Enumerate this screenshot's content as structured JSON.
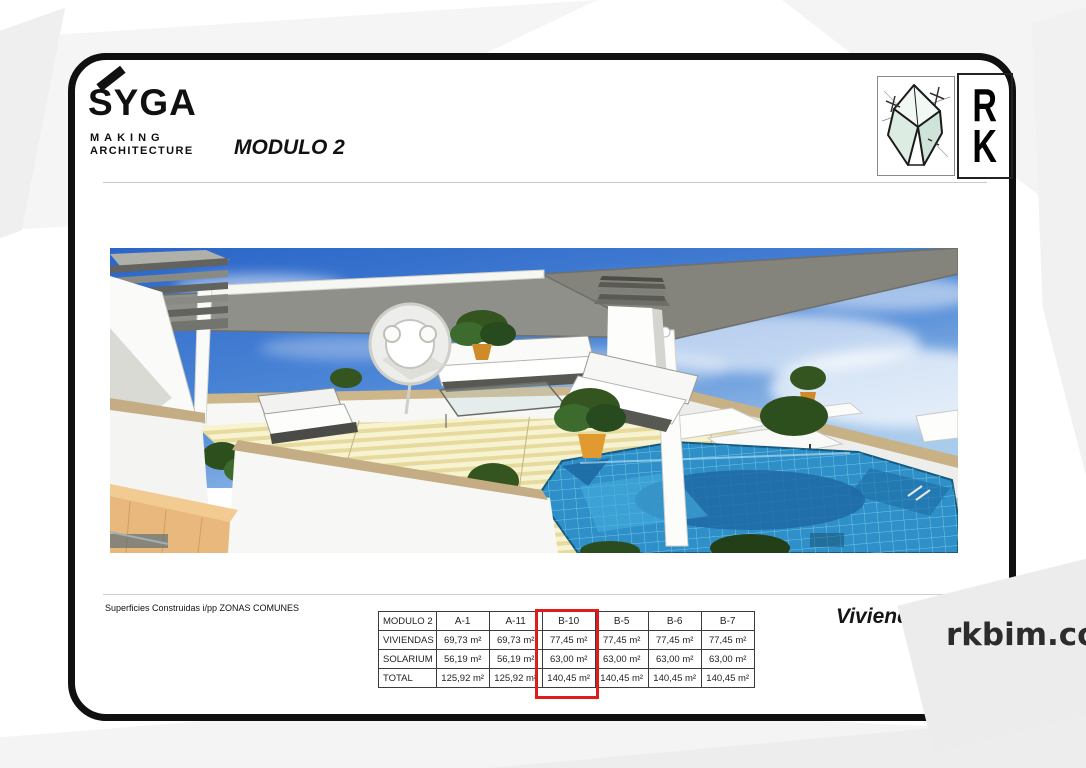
{
  "brand": {
    "name": "SYGA",
    "tagline1": "MAKING",
    "tagline2": "ARCHITECTURE"
  },
  "title": "MODULO 2",
  "rk": {
    "letter_r": "R",
    "letter_k": "K"
  },
  "footer": {
    "note": "Superficies Construidas i/pp ZONAS COMUNES",
    "dwelling": "Vivienda B"
  },
  "watermark": {
    "text": "rkbim.com"
  },
  "table": {
    "corner_label": "MODULO 2",
    "columns": [
      "A-1",
      "A-11",
      "B-10",
      "B-5",
      "B-6",
      "B-7"
    ],
    "highlighted_column": "B-10",
    "rows": [
      {
        "label": "VIVIENDAS",
        "values": [
          "69,73 m²",
          "69,73 m²",
          "77,45 m²",
          "77,45 m²",
          "77,45 m²",
          "77,45 m²"
        ]
      },
      {
        "label": "SOLARIUM",
        "values": [
          "56,19 m²",
          "56,19 m²",
          "63,00 m²",
          "63,00 m²",
          "63,00 m²",
          "63,00 m²"
        ]
      },
      {
        "label": "TOTAL",
        "values": [
          "125,92 m²",
          "125,92 m²",
          "140,45 m²",
          "140,45 m²",
          "140,45 m²",
          "140,45 m²"
        ]
      }
    ]
  },
  "colors": {
    "highlight_red": "#e01b1b",
    "frame_black": "#101010",
    "watermark_gray": "#ececec",
    "sky_blue": "#2a65c8",
    "pool_blue": "#2f8fc9",
    "deck_tan": "#e6da9e"
  }
}
